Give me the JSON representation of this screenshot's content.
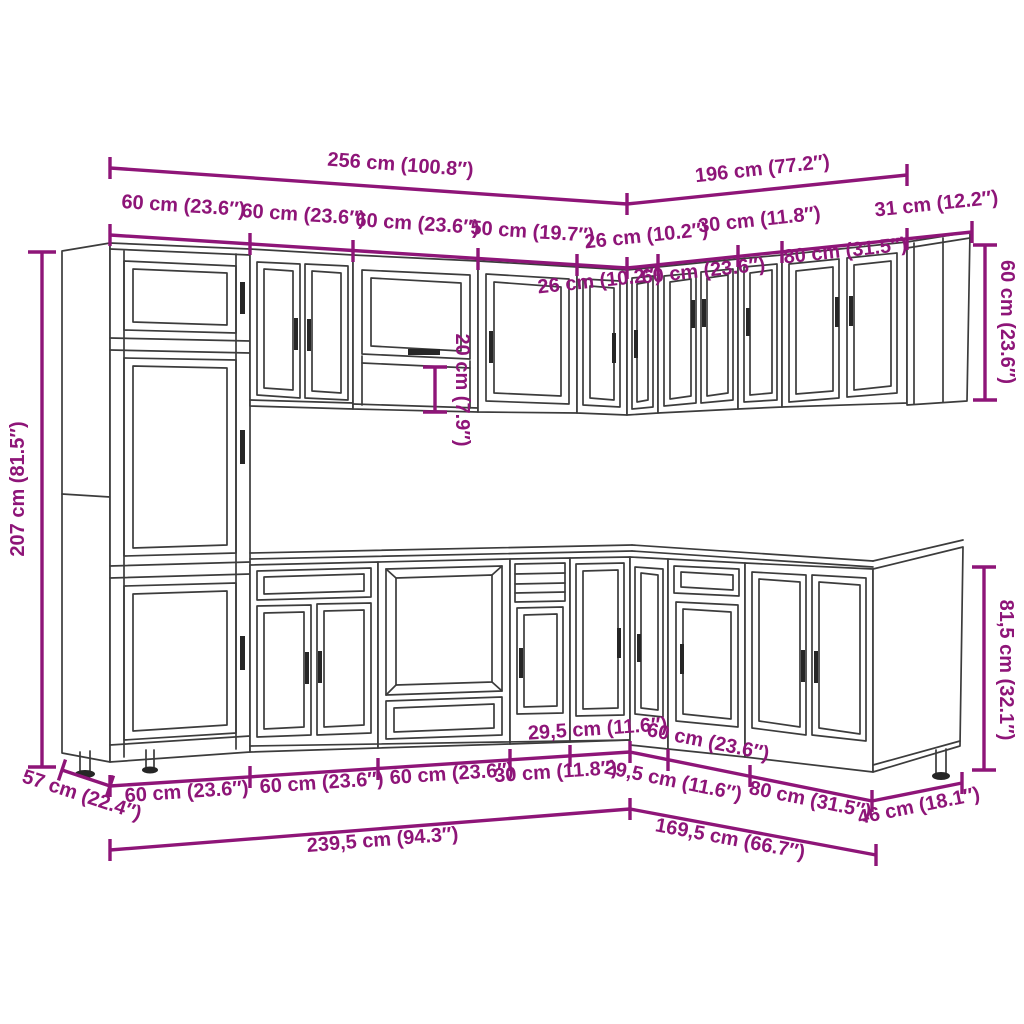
{
  "diagram": {
    "type": "kitchen-cabinet-set-dimension-drawing",
    "accent_color": "#8E1578",
    "line_color": "#3C3C3C",
    "wall_section": {
      "left_run_total": "256 cm (100.8″)",
      "right_run_total": "196 cm (77.2″)",
      "left_run_segments": [
        "60 cm (23.6″)",
        "60 cm (23.6″)",
        "60 cm (23.6″)",
        "50 cm (19.7″)"
      ],
      "right_run_row_upper": [
        "26 cm (10.2″)",
        "30 cm (11.8″)",
        "31 cm (12.2″)"
      ],
      "right_run_row_lower": [
        "26 cm (10.2″)",
        "60 cm (23.6″)",
        "80 cm (31.5″)"
      ],
      "tall_cabinet_height": "207 cm (81.5″)",
      "open_shelf_gap": "20 cm (7.9″)",
      "end_wall_cabinet_height": "60 cm (23.6″)"
    },
    "base_section": {
      "left_depth": "57 cm (22.4″)",
      "left_run_segments": [
        "60 cm (23.6″)",
        "60 cm (23.6″)",
        "60 cm (23.6″)",
        "30 cm (11.8″)",
        "29,5 cm (11.6″)"
      ],
      "right_run_segments": [
        "29,5 cm (11.6″)",
        "60 cm (23.6″)",
        "80 cm (31.5″)"
      ],
      "right_depth": "46 cm (18.1″)",
      "base_cabinet_height": "81,5 cm (32.1″)",
      "left_run_total": "239,5 cm (94.3″)",
      "right_run_total": "169,5 cm (66.7″)"
    }
  }
}
